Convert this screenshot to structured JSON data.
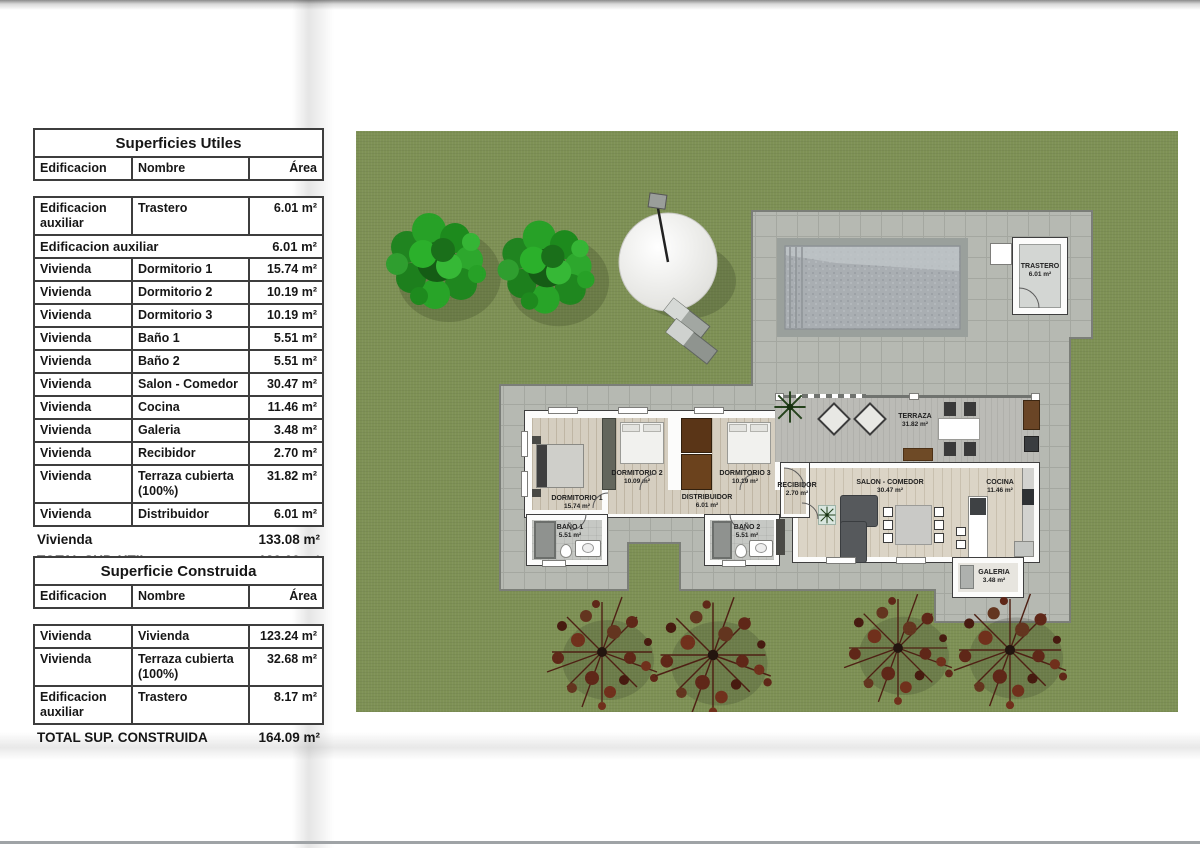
{
  "tables": {
    "utiles": {
      "title": "Superficies Utiles",
      "columns": {
        "edificacion": "Edificacion",
        "nombre": "Nombre",
        "area": "Área"
      },
      "rows_pre": [
        {
          "e": "Edificacion auxiliar",
          "n": "Trastero",
          "a": "6.01 m²"
        }
      ],
      "sub1": {
        "label": "Edificacion auxiliar",
        "area": "6.01 m²"
      },
      "rows": [
        {
          "e": "Vivienda",
          "n": "Dormitorio 1",
          "a": "15.74 m²"
        },
        {
          "e": "Vivienda",
          "n": "Dormitorio 2",
          "a": "10.19 m²"
        },
        {
          "e": "Vivienda",
          "n": "Dormitorio 3",
          "a": "10.19 m²"
        },
        {
          "e": "Vivienda",
          "n": "Baño 1",
          "a": "5.51 m²"
        },
        {
          "e": "Vivienda",
          "n": "Baño 2",
          "a": "5.51 m²"
        },
        {
          "e": "Vivienda",
          "n": "Salon - Comedor",
          "a": "30.47 m²"
        },
        {
          "e": "Vivienda",
          "n": "Cocina",
          "a": "11.46 m²"
        },
        {
          "e": "Vivienda",
          "n": "Galeria",
          "a": "3.48 m²"
        },
        {
          "e": "Vivienda",
          "n": "Recibidor",
          "a": "2.70 m²"
        },
        {
          "e": "Vivienda",
          "n": "Terraza cubierta (100%)",
          "a": "31.82 m²"
        },
        {
          "e": "Vivienda",
          "n": "Distribuidor",
          "a": "6.01 m²"
        }
      ],
      "sub2": {
        "label": "Vivienda",
        "area": "133.08 m²"
      },
      "total": {
        "label": "TOTAL SUP. UTIL",
        "area": "139.09 m²"
      }
    },
    "construida": {
      "title": "Superficie Construida",
      "columns": {
        "edificacion": "Edificacion",
        "nombre": "Nombre",
        "area": "Área"
      },
      "rows": [
        {
          "e": "Vivienda",
          "n": "Vivienda",
          "a": "123.24 m²"
        },
        {
          "e": "Vivienda",
          "n": "Terraza cubierta (100%)",
          "a": "32.68 m²"
        },
        {
          "e": "Edificacion auxiliar",
          "n": "Trastero",
          "a": "8.17 m²"
        }
      ],
      "total": {
        "label": "TOTAL SUP. CONSTRUIDA",
        "area": "164.09 m²"
      }
    }
  },
  "plan": {
    "rooms": {
      "trastero": {
        "name": "TRASTERO",
        "area": "6.01 m²"
      },
      "terraza": {
        "name": "TERRAZA",
        "area": "31.82 m²"
      },
      "dormitorio1": {
        "name": "DORMITORIO 1",
        "area": "15.74 m²"
      },
      "dormitorio2": {
        "name": "DORMITORIO 2",
        "area": "10.09 m²"
      },
      "dormitorio3": {
        "name": "DORMITORIO 3",
        "area": "10.19 m²"
      },
      "distribuidor": {
        "name": "DISTRIBUIDOR",
        "area": "6.01 m²"
      },
      "recibidor": {
        "name": "RECIBIDOR",
        "area": "2.70 m²"
      },
      "bano1": {
        "name": "BAÑO 1",
        "area": "5.51 m²"
      },
      "bano2": {
        "name": "BAÑO 2",
        "area": "5.51 m²"
      },
      "salon": {
        "name": "SALON - COMEDOR",
        "area": "30.47 m²"
      },
      "cocina": {
        "name": "COCINA",
        "area": "11.46 m²"
      },
      "galeria": {
        "name": "GALERIA",
        "area": "3.48 m²"
      }
    },
    "colors": {
      "lawn": "#7e9155",
      "paving": "#b6b9b2",
      "pool_water": "#a9aeb2",
      "wall": "#fcfcfb",
      "wood_floor": "#d5cec0",
      "tree_green": "#27a127",
      "tree_red": "#5f2718",
      "wardrobe_brown": "#5a3517",
      "sofa_gray": "#56595c"
    }
  }
}
